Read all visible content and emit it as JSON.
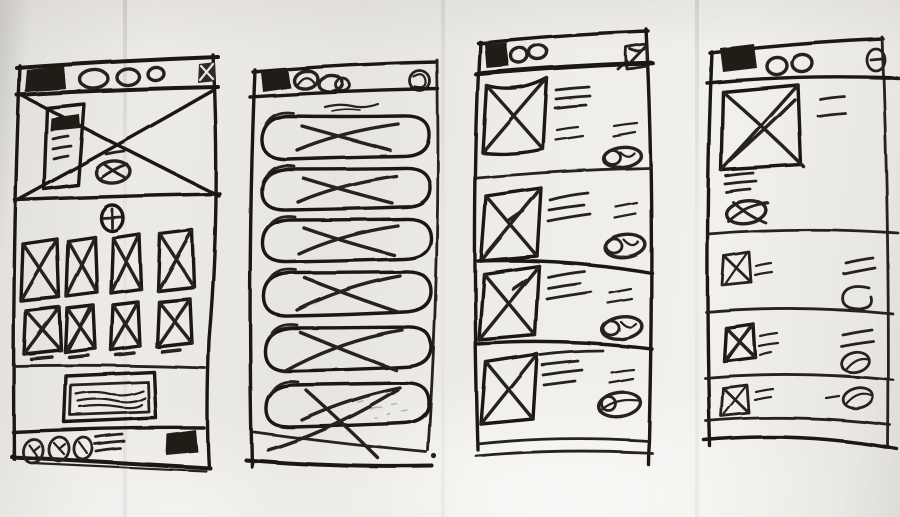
{
  "document": {
    "kind": "photographed hand-drawn mobile wireframe sketch",
    "medium": "black ink on creased paper",
    "screen_count": 4
  },
  "palette": {
    "paper": "#edebe8",
    "paper_shadow": "#c6c4c1",
    "paper_highlight": "#faf9f7",
    "ink": "#26221f",
    "ink_heavy": "#1b1815",
    "pencil_smudge": "#a7a39d"
  },
  "screens": [
    {
      "id": "screen-1",
      "title": "home / gallery screen",
      "header": [
        "logo-block",
        "tab-oval-large",
        "tab-oval-medium",
        "tab-oval-small",
        "close-box-icon"
      ],
      "body": [
        "hero-image-placeholder-x",
        "content-card-with-text-lines",
        "play-oval-button",
        "add-circle-button"
      ],
      "grid": {
        "rows": 2,
        "cols": 4,
        "cell": "thumbnail-with-x",
        "cells": 8
      },
      "banner": "ad-banner-with-squiggle-text",
      "footer": [
        "clock-oval-icon",
        "clock-oval-icon",
        "clock-oval-icon",
        "menu-lines",
        "logo-block"
      ]
    },
    {
      "id": "screen-2",
      "title": "list screen with pill rows",
      "header": [
        "logo-block",
        "tab-oval",
        "tab-oval-double",
        "scribble-circle-icon"
      ],
      "subheader": "squiggle-caption-line",
      "list": {
        "count": 6,
        "item": "pill-row-with-x-scribble"
      }
    },
    {
      "id": "screen-3",
      "title": "feed screen with thumbnail list",
      "header": [
        "logo-block",
        "tab-oval",
        "tab-oval",
        "send-flag-icon"
      ],
      "list": {
        "count": 4,
        "item": [
          "thumbnail-with-x",
          "text-lines-3",
          "meta-lines-2",
          "oval-scribble-button"
        ],
        "dividers": 3
      }
    },
    {
      "id": "screen-4",
      "title": "detail screen with compact rows",
      "header": [
        "logo-block",
        "tab-oval",
        "tab-oval",
        "minus-circle-icon"
      ],
      "detail": [
        "large-image-placeholder-x",
        "caption-lines-2",
        "text-lines-3",
        "oval-button-with-x"
      ],
      "list": {
        "count": 3,
        "item": [
          "checkbox-with-x",
          "text-tick-lines",
          "meta-lines",
          "oval-scribble"
        ],
        "dividers": 2
      }
    }
  ]
}
